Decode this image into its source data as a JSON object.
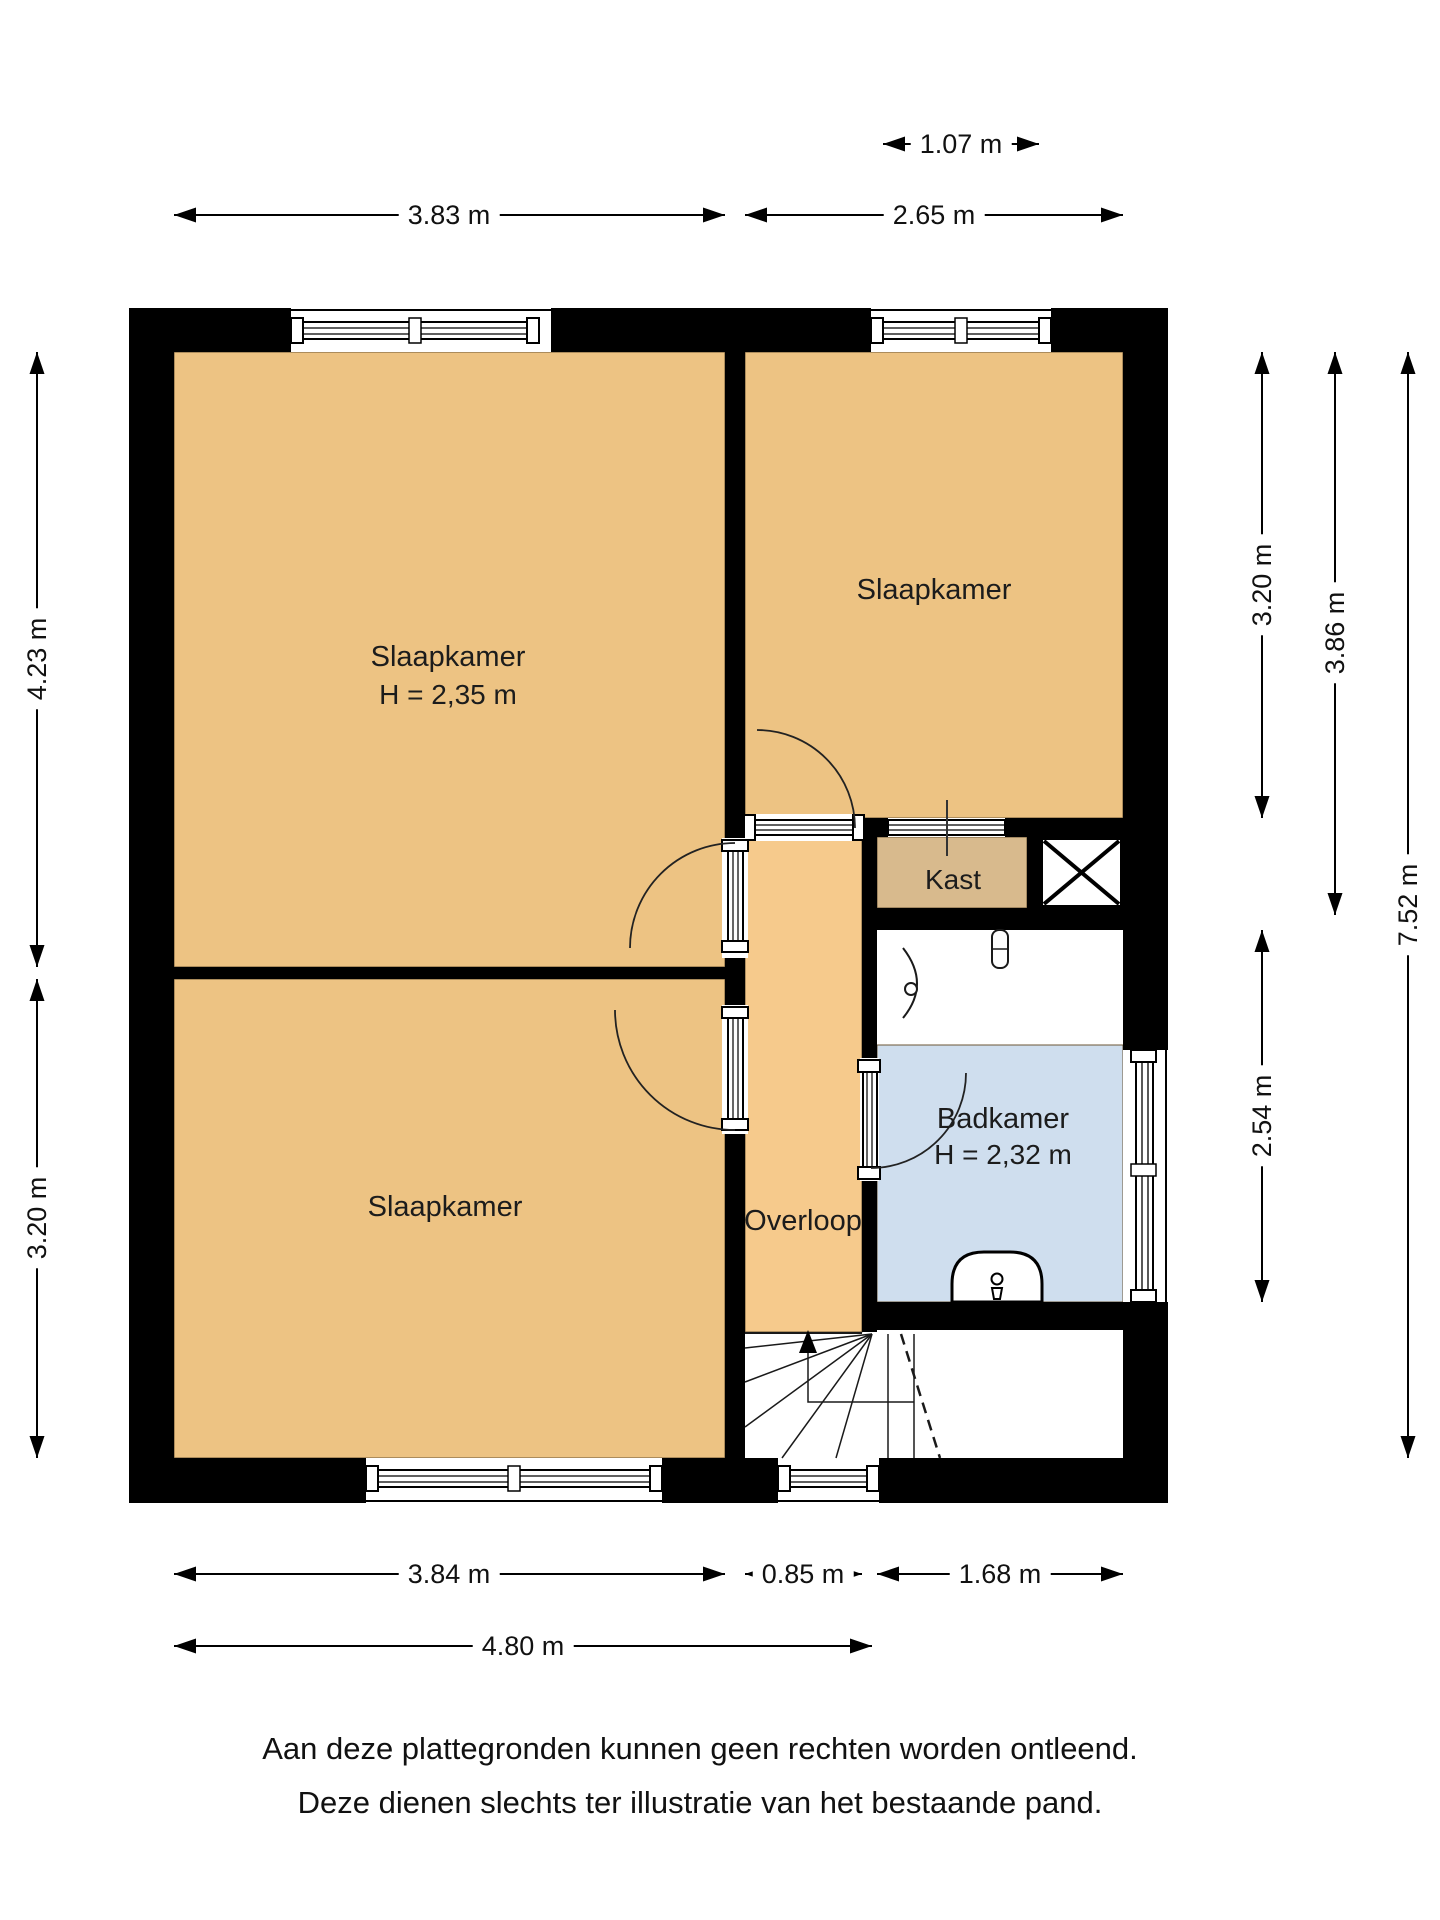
{
  "title": "Plattegrond verdieping",
  "colors": {
    "wall": "#000000",
    "bedroom_fill": "#edc383",
    "overloop_fill": "#f6ca8c",
    "kast_fill": "#d8ba8d",
    "badkamer_fill": "#cfdeee",
    "fixture_white": "#ffffff",
    "text": "#1c1c1c"
  },
  "rooms": {
    "bedroom_left_top": {
      "label": "Slaapkamer",
      "height_label": "H = 2,35 m"
    },
    "bedroom_top_right": {
      "label": "Slaapkamer"
    },
    "bedroom_left_bottom": {
      "label": "Slaapkamer"
    },
    "overloop": {
      "label": "Overloop"
    },
    "kast": {
      "label": "Kast"
    },
    "badkamer": {
      "label": "Badkamer",
      "height_label": "H = 2,32 m"
    }
  },
  "icons": {
    "stairs_up_arrow": "stairs-direction-up",
    "toilet": "toilet-fixture",
    "washbasin": "washbasin-fixture",
    "shaft_cross": "shaft-x-symbol"
  },
  "dimensions": {
    "top": [
      {
        "label": "1.07 m"
      },
      {
        "label": "3.83 m"
      },
      {
        "label": "2.65 m"
      }
    ],
    "left": [
      {
        "label": "4.23 m"
      },
      {
        "label": "3.20 m"
      }
    ],
    "right": [
      {
        "label": "3.20 m"
      },
      {
        "label": "3.86 m"
      },
      {
        "label": "2.54 m"
      },
      {
        "label": "7.52 m"
      }
    ],
    "bottom": [
      {
        "label": "3.84 m"
      },
      {
        "label": "0.85 m"
      },
      {
        "label": "1.68 m"
      },
      {
        "label": "4.80 m"
      }
    ]
  },
  "footer": {
    "line1": "Aan deze plattegronden kunnen geen rechten worden ontleend.",
    "line2": "Deze dienen slechts ter illustratie van het bestaande pand."
  }
}
